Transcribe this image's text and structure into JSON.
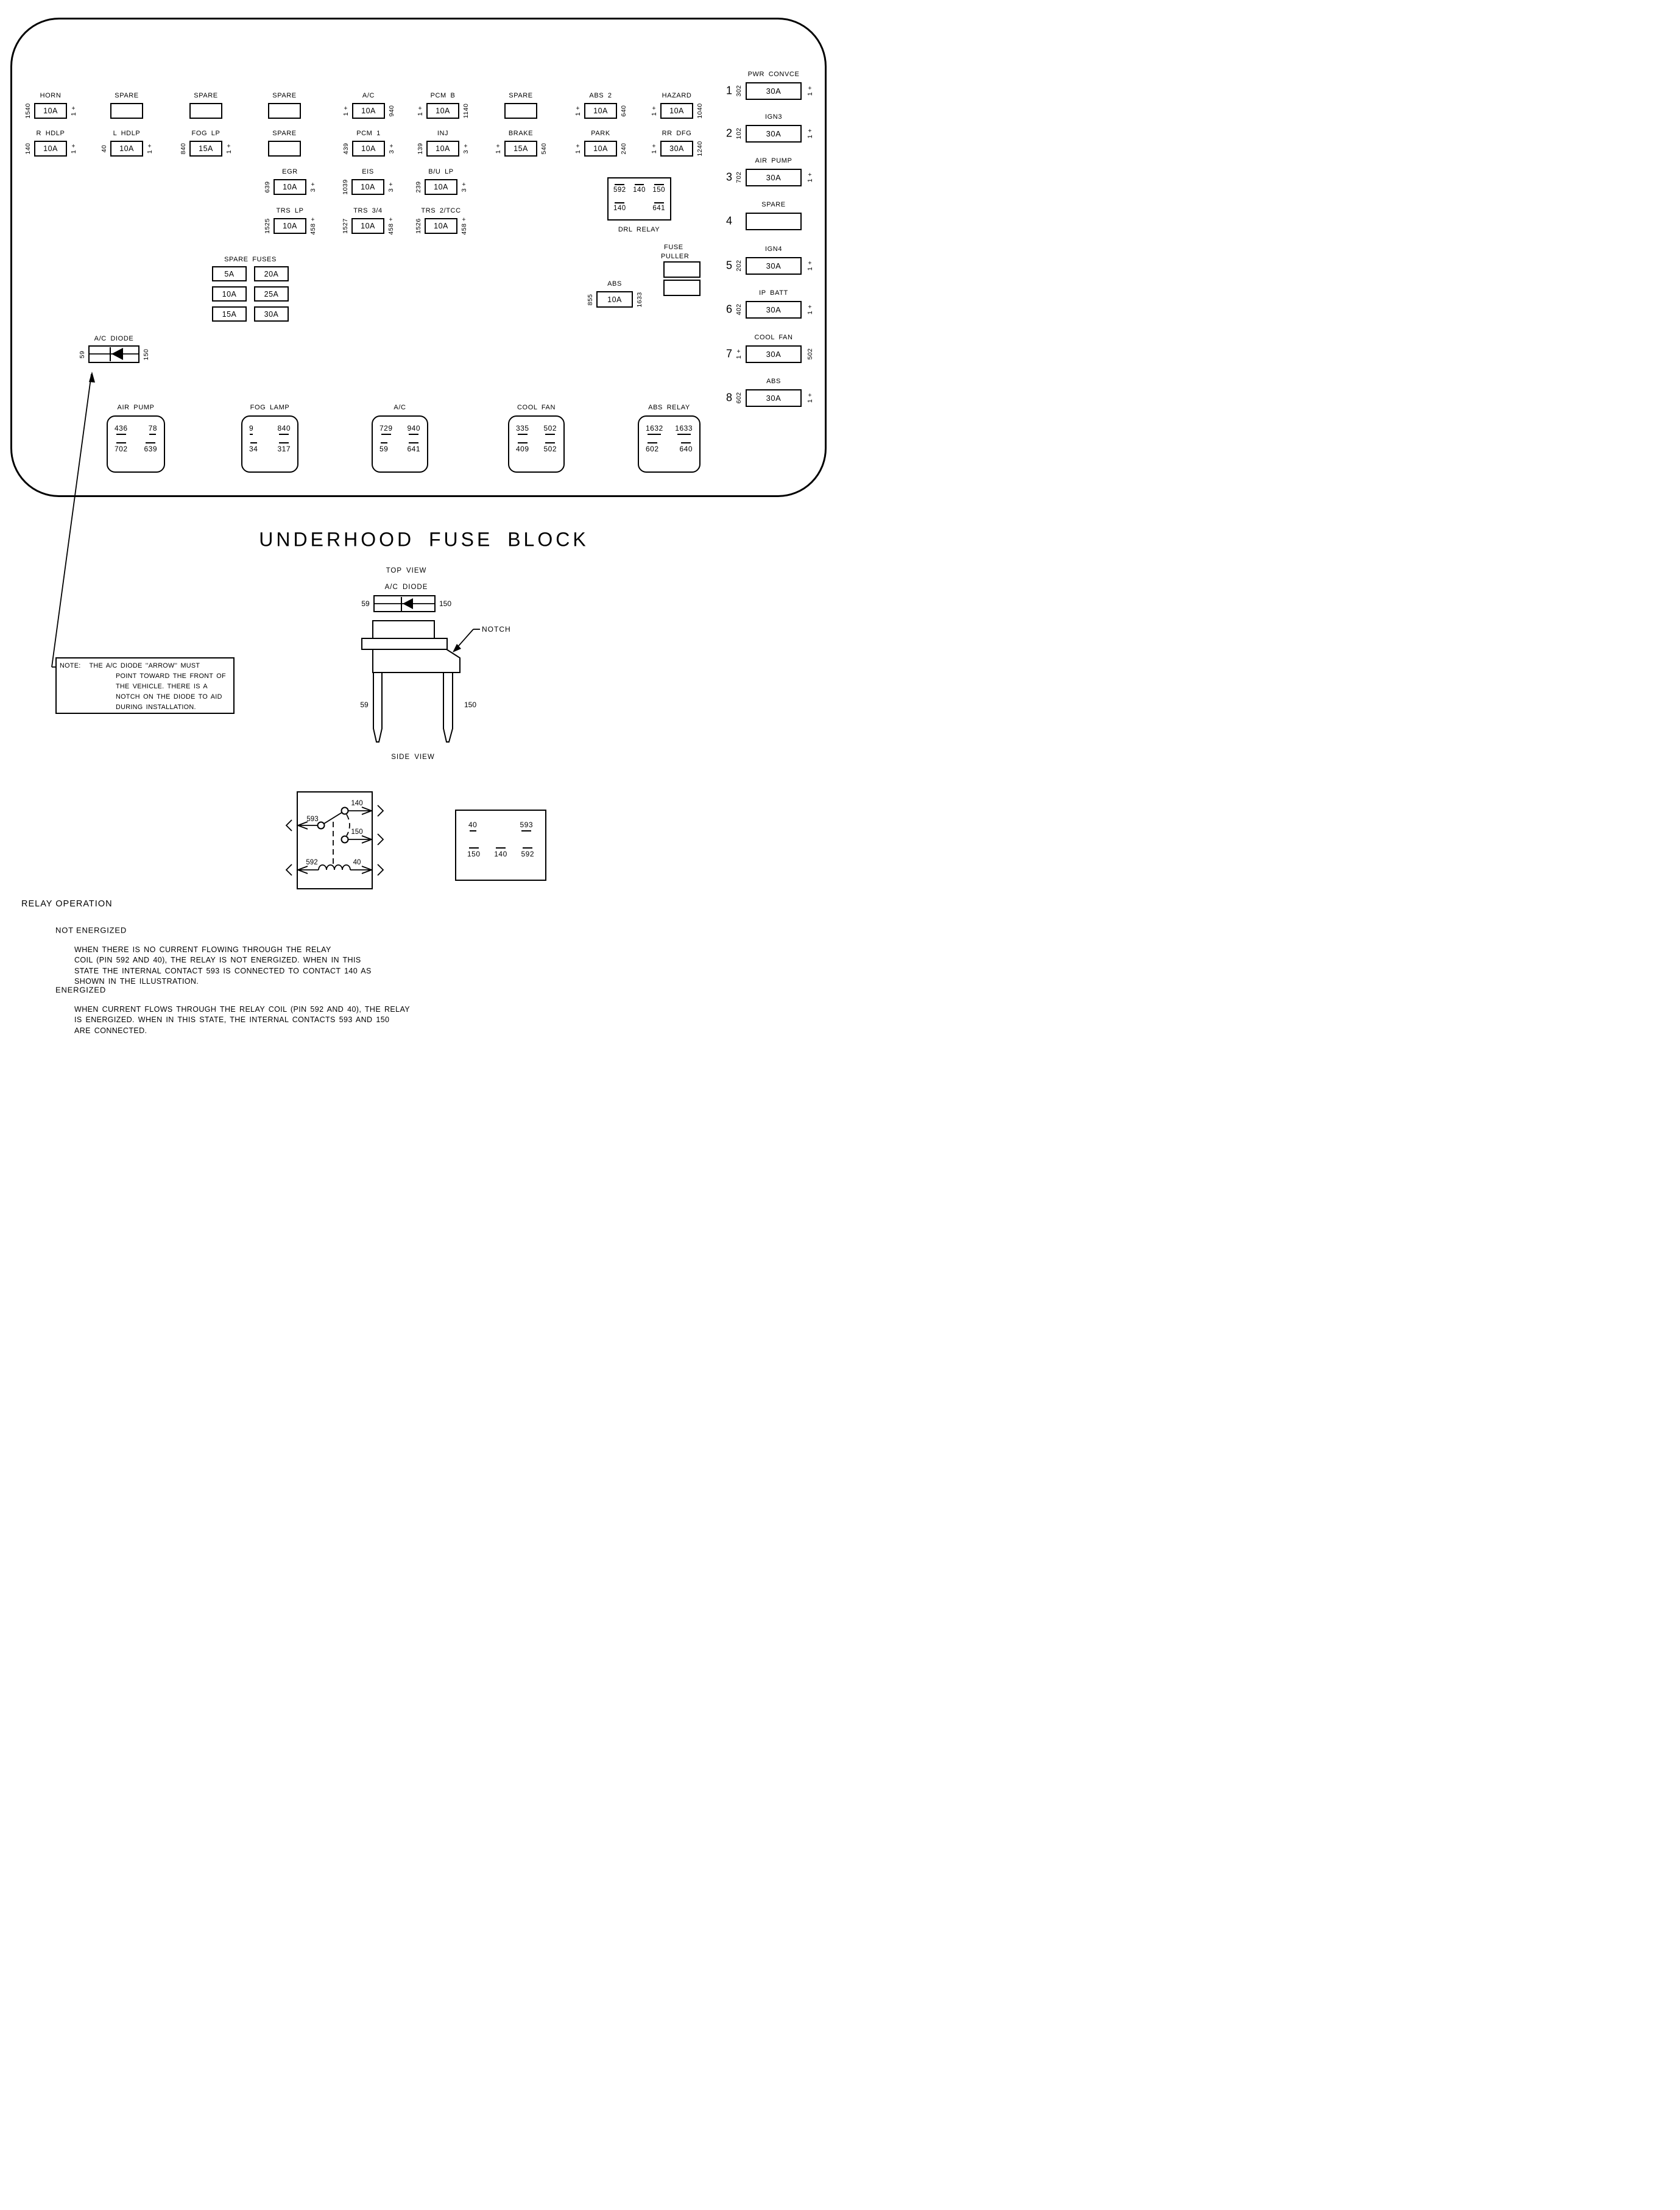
{
  "title": "UNDERHOOD FUSE BLOCK",
  "fuse_block": {
    "fuses": [
      {
        "label": "HORN",
        "amp": "10A",
        "left": "1540",
        "right": "1 +"
      },
      {
        "label": "SPARE",
        "amp": "",
        "left": "",
        "right": ""
      },
      {
        "label": "SPARE",
        "amp": "",
        "left": "",
        "right": ""
      },
      {
        "label": "SPARE",
        "amp": "",
        "left": "",
        "right": ""
      },
      {
        "label": "A/C",
        "amp": "10A",
        "left": "1 +",
        "right": "940"
      },
      {
        "label": "PCM B",
        "amp": "10A",
        "left": "1 +",
        "right": "1140"
      },
      {
        "label": "SPARE",
        "amp": "",
        "left": "",
        "right": ""
      },
      {
        "label": "ABS 2",
        "amp": "10A",
        "left": "1 +",
        "right": "640"
      },
      {
        "label": "HAZARD",
        "amp": "10A",
        "left": "1 +",
        "right": "1040"
      },
      {
        "label": "R HDLP",
        "amp": "10A",
        "left": "140",
        "right": "1 +"
      },
      {
        "label": "L HDLP",
        "amp": "10A",
        "left": "40",
        "right": "1 +"
      },
      {
        "label": "FOG LP",
        "amp": "15A",
        "left": "840",
        "right": "1 +"
      },
      {
        "label": "SPARE",
        "amp": "",
        "left": "",
        "right": ""
      },
      {
        "label": "PCM 1",
        "amp": "10A",
        "left": "439",
        "right": "3 +"
      },
      {
        "label": "INJ",
        "amp": "10A",
        "left": "139",
        "right": "3 +"
      },
      {
        "label": "BRAKE",
        "amp": "15A",
        "left": "1 +",
        "right": "540"
      },
      {
        "label": "PARK",
        "amp": "10A",
        "left": "1 +",
        "right": "240"
      },
      {
        "label": "RR DFG",
        "amp": "30A",
        "left": "1 +",
        "right": "1240"
      },
      {
        "label": "EGR",
        "amp": "10A",
        "left": "639",
        "right": "3 +"
      },
      {
        "label": "EIS",
        "amp": "10A",
        "left": "1039",
        "right": "3 +"
      },
      {
        "label": "B/U LP",
        "amp": "10A",
        "left": "239",
        "right": "3 +"
      },
      {
        "label": "TRS LP",
        "amp": "10A",
        "left": "1525",
        "right": "458 +"
      },
      {
        "label": "TRS 3/4",
        "amp": "10A",
        "left": "1527",
        "right": "458 +"
      },
      {
        "label": "TRS 2/TCC",
        "amp": "10A",
        "left": "1526",
        "right": "458 +"
      },
      {
        "label": "ABS",
        "amp": "10A",
        "left": "855",
        "right": "1633"
      }
    ],
    "spare_fuses": {
      "title": "SPARE FUSES",
      "amps": [
        "5A",
        "20A",
        "10A",
        "25A",
        "15A",
        "30A"
      ]
    },
    "drl_relay": {
      "label": "DRL RELAY",
      "top_pins": [
        "592",
        "140",
        "150"
      ],
      "bottom_pins": [
        "140",
        "641"
      ]
    },
    "fuse_puller": {
      "line1": "FUSE",
      "line2": "PULLER"
    },
    "ac_diode": {
      "label": "A/C DIODE",
      "left": "59",
      "right": "150"
    },
    "relays": [
      {
        "label": "AIR PUMP",
        "top": [
          "436",
          "78"
        ],
        "bottom": [
          "702",
          "639"
        ]
      },
      {
        "label": "FOG LAMP",
        "top": [
          "9",
          "840"
        ],
        "bottom": [
          "34",
          "317"
        ]
      },
      {
        "label": "A/C",
        "top": [
          "729",
          "940"
        ],
        "bottom": [
          "59",
          "641"
        ]
      },
      {
        "label": "COOL FAN",
        "top": [
          "335",
          "502"
        ],
        "bottom": [
          "409",
          "502"
        ]
      },
      {
        "label": "ABS RELAY",
        "top": [
          "1632",
          "1633"
        ],
        "bottom": [
          "602",
          "640"
        ]
      }
    ],
    "right_items": [
      {
        "num": "1",
        "label": "PWR CONVCE",
        "amp": "30A",
        "left": "302",
        "right": "1 +"
      },
      {
        "num": "2",
        "label": "IGN3",
        "amp": "30A",
        "left": "102",
        "right": "1 +"
      },
      {
        "num": "3",
        "label": "AIR PUMP",
        "amp": "30A",
        "left": "702",
        "right": "1 +"
      },
      {
        "num": "4",
        "label": "SPARE",
        "amp": "",
        "left": "",
        "right": ""
      },
      {
        "num": "5",
        "label": "IGN4",
        "amp": "30A",
        "left": "202",
        "right": "1 +"
      },
      {
        "num": "6",
        "label": "IP BATT",
        "amp": "30A",
        "left": "402",
        "right": "1 +"
      },
      {
        "num": "7",
        "label": "COOL FAN",
        "amp": "30A",
        "left": "1 +",
        "right": "502"
      },
      {
        "num": "8",
        "label": "ABS",
        "amp": "30A",
        "left": "602",
        "right": "1 +"
      }
    ]
  },
  "top_view": {
    "label": "TOP VIEW",
    "diode_label": "A/C DIODE",
    "left": "59",
    "right": "150"
  },
  "side_view": {
    "label": "SIDE VIEW",
    "notch_label": "NOTCH",
    "left_pin": "59",
    "right_pin": "150"
  },
  "note": {
    "prefix": "NOTE:",
    "lines": [
      "THE A/C DIODE ''ARROW'' MUST",
      "POINT TOWARD THE FRONT OF",
      "THE VEHICLE.  THERE IS A",
      "NOTCH ON THE DIODE TO AID",
      "DURING INSTALLATION."
    ]
  },
  "relay_schematic": {
    "labels": {
      "p140": "140",
      "p593": "593",
      "p150": "150",
      "p592": "592",
      "p40": "40"
    }
  },
  "pin_box": {
    "top": [
      "40",
      "593"
    ],
    "bottom": [
      "150",
      "140",
      "592"
    ]
  },
  "relay_operation": {
    "heading": "RELAY OPERATION",
    "sections": [
      {
        "title": "NOT ENERGIZED",
        "lines": [
          "WHEN THERE IS NO CURRENT FLOWING THROUGH THE RELAY",
          "COIL (PIN 592 AND 40), THE RELAY IS NOT ENERGIZED.  WHEN IN THIS",
          "STATE THE INTERNAL CONTACT 593 IS CONNECTED TO CONTACT 140 AS",
          "SHOWN IN THE ILLUSTRATION."
        ]
      },
      {
        "title": "ENERGIZED",
        "lines": [
          "WHEN CURRENT FLOWS THROUGH THE RELAY COIL (PIN 592 AND 40), THE RELAY",
          "IS ENERGIZED.  WHEN IN THIS STATE, THE INTERNAL CONTACTS 593 AND 150",
          "ARE CONNECTED."
        ]
      }
    ]
  }
}
